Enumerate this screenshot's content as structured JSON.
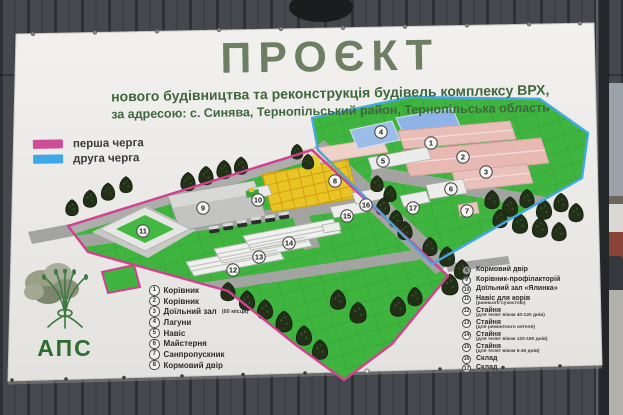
{
  "banner": {
    "title": "ПРОЄКТ",
    "subtitle1": "нового будівництва та реконструкція будівель комплексу ВРХ,",
    "subtitle2": "за адресою: с. Синява, Тернопільський район, Тернопільська область"
  },
  "legend": {
    "phase1_label": "перша черга",
    "phase2_label": "друга черга",
    "phase1_color": "#cf4d96",
    "phase2_color": "#3da7e8"
  },
  "logo": {
    "text": "АПС"
  },
  "lists": {
    "left": [
      {
        "num": "1",
        "label": "Корівник"
      },
      {
        "num": "2",
        "label": "Корівник"
      },
      {
        "num": "3",
        "label": "Доїльний зал",
        "sub": "(60 місць)"
      },
      {
        "num": "4",
        "label": "Лагуни"
      },
      {
        "num": "5",
        "label": "Навіс"
      },
      {
        "num": "6",
        "label": "Майстерня"
      },
      {
        "num": "7",
        "label": "Санпропускник"
      },
      {
        "num": "8",
        "label": "Кормовий двір"
      }
    ],
    "right": [
      {
        "num": "8",
        "label": "Кормовий двір"
      },
      {
        "num": "9",
        "label": "Корівник-профілакторій"
      },
      {
        "num": "10",
        "label": "Доїльний зал «Ялинка»"
      },
      {
        "num": "11",
        "label": "Навіс для корів",
        "sub": "(раннього сухостою)"
      },
      {
        "num": "12",
        "label": "Стайня",
        "sub": "(для телят віком 40-120 днів)"
      },
      {
        "num": "13",
        "label": "Стайня",
        "sub": "(для ремонтного нетеля)"
      },
      {
        "num": "14",
        "label": "Стайня",
        "sub": "(для телят віком 120-180 днів)"
      },
      {
        "num": "15",
        "label": "Стайня",
        "sub": "(для телят віком 5-40 днів)"
      },
      {
        "num": "16",
        "label": "Склад"
      },
      {
        "num": "17",
        "label": "Склад"
      }
    ]
  },
  "map": {
    "field_color": "#3fb53f",
    "markers": [
      {
        "label": "1"
      },
      {
        "label": "2"
      },
      {
        "label": "3"
      },
      {
        "label": "4"
      },
      {
        "label": "5"
      },
      {
        "label": "6"
      },
      {
        "label": "7"
      },
      {
        "label": "8"
      },
      {
        "label": "9"
      },
      {
        "label": "10"
      },
      {
        "label": "11"
      },
      {
        "label": "12"
      },
      {
        "label": "13"
      },
      {
        "label": "14"
      },
      {
        "label": "15"
      },
      {
        "label": "16"
      },
      {
        "label": "17"
      }
    ]
  }
}
